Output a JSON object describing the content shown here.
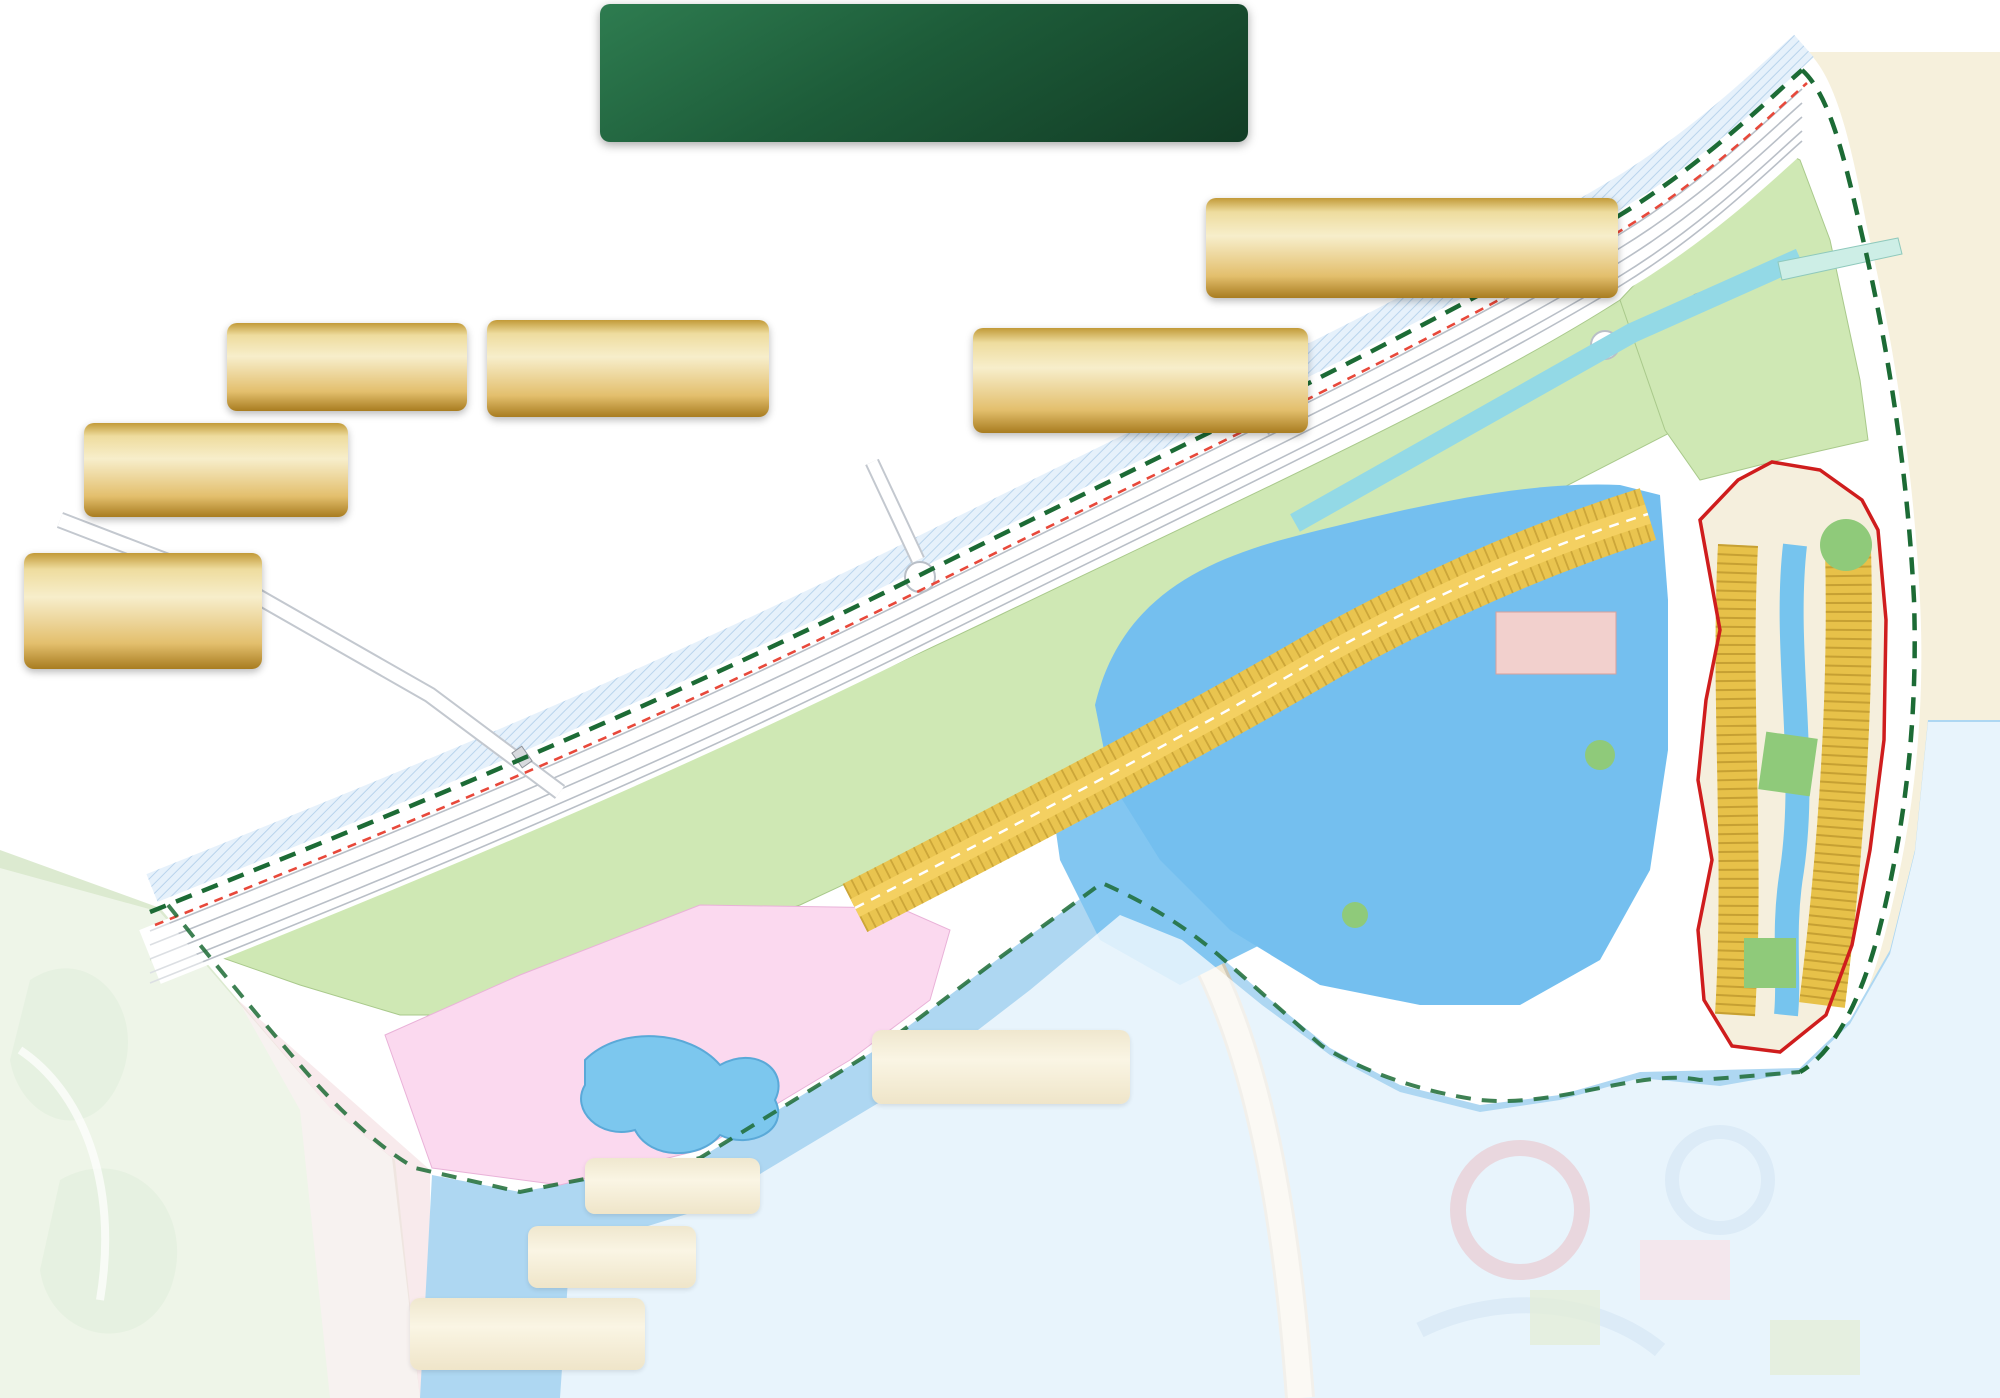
{
  "banner": {
    "title": "THE GREEN BAY - VỊNH NGỌC",
    "area": "586,9 ha"
  },
  "callouts": {
    "nha_thi_dau": {
      "l1": "NHÀ THI ĐẤU ĐA NĂNG"
    },
    "benh_vien": {
      "l1": "BỆNH VIỆN VINMEC",
      "l2": "CLEVERLAND CONNECTED",
      "l3": "7,4 ha"
    },
    "tttm": {
      "l1": "TTTM VINCOM PLAZA - CHỢ ĐÊM &",
      "l2": "CHỢ ĐẶC SẢN 3 MIỀN BAYSIZE MARKET",
      "l3": "2,7ha - 4 tầng"
    },
    "khach_san": {
      "l1": "KHÁCH SẠN 5 SAO",
      "l2": "THƯƠNG HIỆU TOP ĐẦU THẾ GIỚI",
      "l3": "9 tầng 4,2ha"
    },
    "trung_tam": {
      "l1": "TRUNG TÂM CỘNG ĐỒNG",
      "l2": "YOUNG PARADISE HUB",
      "l3": "4,6ha"
    },
    "ga_depot": {
      "l1": "GA DEPOT Q7 - CẦN GIỜ",
      "l2": "& TTTM VINCOM",
      "l3": "MEGA MALL"
    },
    "van_phong": {
      "l1": "VĂN PHÒNG - 15 TẦNG"
    },
    "ks_mini": {
      "l1": "KHÁCH SẠN 5 SAO",
      "l2": "25 tầng - 0,9ha"
    },
    "nha_hat": {
      "l1": "NHÀ HÁT SÓNG XANH",
      "l2": "BLUE WAVES THEATRE"
    },
    "bien_nuoc": {
      "l1": "BIỂN NƯỚC MẶN",
      "l2": "PARADISE LAGOON HƠN 800HA"
    }
  },
  "map_labels": {
    "dat_du_tru": "ĐẤT DỰ TRỮ",
    "phat_trien": "PHÁT TRIỂN",
    "tmdv": "TMDV",
    "giao_duc": "GIÁO DỤC",
    "van_hoa": "VĂN HÓA",
    "y_te": "Y TẾ",
    "p": "P",
    "van_phong": "VĂN PHÒNG",
    "ha_tang_1": "HẠ TẦNG",
    "ha_tang_2": "KỸ THUẬT",
    "quoc_phong_1": "QUỐC",
    "quoc_phong_2": "PHÒNG",
    "mo_hinh_1": "MÔ HÌNH CHÙA VN",
    "mo_hinh_2": "CÔNG TRÌNH",
    "mo_hinh_3": "VĂN HÓA",
    "bt_bien": "BT BIỂN, KS MINI",
    "di": "ĐI",
    "tt_can_thanh": "TT. CẦN THẠNH",
    "di_tt": "ĐI TT. CẦN THẠNH",
    "dai_lo": "ĐẠI LỘ THỜI ĐẠI - 120m",
    "tuong_lai": "ĐƯỜNG TƯƠNG LAI - 50m",
    "vinh_ngoc": "ĐƯỜNG VỊNH NGỌC - 50m",
    "anh_sang": "ĐƯỜNG ÁNH SÁNG - 50m",
    "areas": {
      "a25": "2,5ha",
      "a52": "5,2ha",
      "a21": "2,1ha",
      "a27": "2,7ha",
      "a09": "0,9ha",
      "a15": "1,5ha",
      "a12": "1,2ha",
      "a24": "2,4ha",
      "a07": "0,7ha",
      "a134": "13,4ha",
      "a26": "2,6ha",
      "a1": "1ha",
      "a06": "0,6ha"
    }
  },
  "markers": {
    "active": [
      "1",
      "16",
      "17",
      "6",
      "20",
      "6",
      "15",
      "14"
    ],
    "faded": [
      "2",
      "18",
      "21",
      "6",
      "19",
      "11",
      "10"
    ]
  },
  "colors": {
    "accent_green": "#1d4d2b",
    "gold": "#d8b04a",
    "boundary_green": "#1c6b35",
    "boundary_red": "#e8483a",
    "water": "#74bfef",
    "parcel_green": "#cfe8b4",
    "marker_gold": "#e9c75f"
  }
}
